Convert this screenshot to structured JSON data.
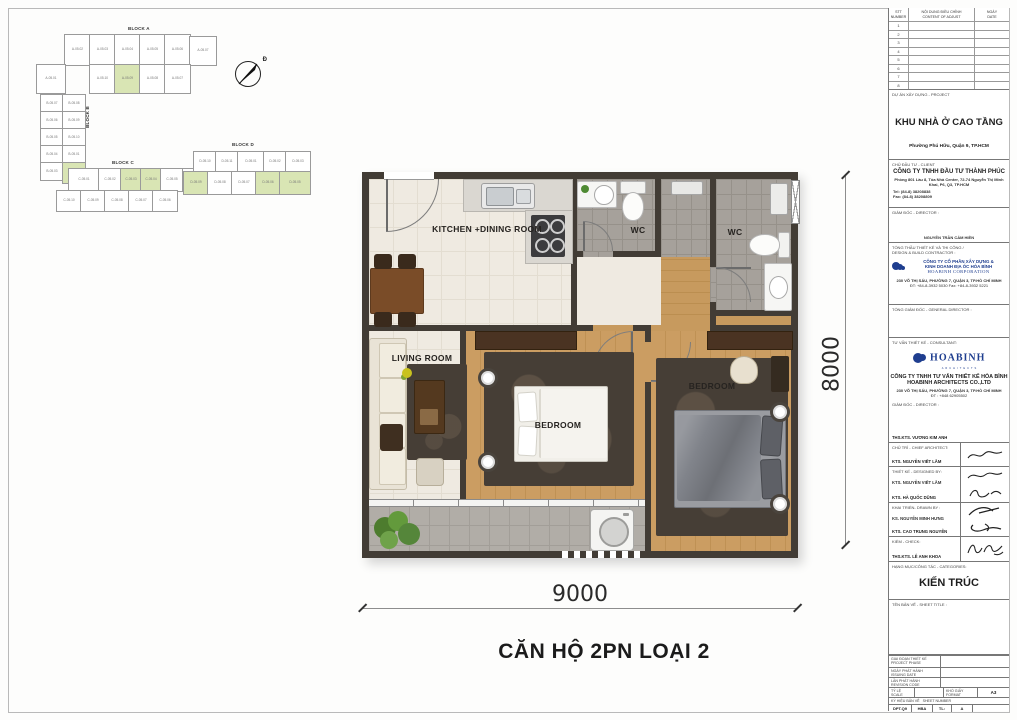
{
  "keyplan": {
    "block_a_label": "BLOCK A",
    "block_b_label": "BLOCK B",
    "block_c_label": "BLOCK C",
    "block_d_label": "BLOCK D",
    "compass_label": "Đ",
    "highlight_color": "#d9e5b4",
    "cells": [
      {
        "x": 36,
        "y": 16,
        "w": 25,
        "h": 30,
        "label": "A-05.02",
        "hl": false
      },
      {
        "x": 61,
        "y": 16,
        "w": 25,
        "h": 30,
        "label": "A-05.03",
        "hl": false
      },
      {
        "x": 86,
        "y": 16,
        "w": 25,
        "h": 30,
        "label": "A-05.04",
        "hl": false
      },
      {
        "x": 111,
        "y": 16,
        "w": 25,
        "h": 30,
        "label": "A-05.05",
        "hl": false
      },
      {
        "x": 136,
        "y": 16,
        "w": 25,
        "h": 30,
        "label": "A-05.06",
        "hl": false
      },
      {
        "x": 161,
        "y": 18,
        "w": 26,
        "h": 28,
        "label": "A-05.07",
        "hl": false
      },
      {
        "x": 8,
        "y": 46,
        "w": 28,
        "h": 28,
        "label": "A-05.01",
        "hl": false
      },
      {
        "x": 61,
        "y": 46,
        "w": 25,
        "h": 28,
        "label": "A-05.10",
        "hl": false
      },
      {
        "x": 86,
        "y": 46,
        "w": 25,
        "h": 28,
        "label": "A-05.09",
        "hl": true
      },
      {
        "x": 111,
        "y": 46,
        "w": 25,
        "h": 28,
        "label": "A-05.08",
        "hl": false
      },
      {
        "x": 136,
        "y": 46,
        "w": 25,
        "h": 28,
        "label": "A-05.07",
        "hl": false
      },
      {
        "x": 12,
        "y": 76,
        "w": 22,
        "h": 17,
        "label": "B-05.07",
        "hl": false
      },
      {
        "x": 34,
        "y": 76,
        "w": 22,
        "h": 17,
        "label": "B-05.08",
        "hl": false
      },
      {
        "x": 12,
        "y": 93,
        "w": 22,
        "h": 17,
        "label": "B-05.06",
        "hl": false
      },
      {
        "x": 34,
        "y": 93,
        "w": 22,
        "h": 17,
        "label": "B-05.09",
        "hl": false
      },
      {
        "x": 12,
        "y": 110,
        "w": 22,
        "h": 17,
        "label": "B-05.05",
        "hl": false
      },
      {
        "x": 34,
        "y": 110,
        "w": 22,
        "h": 17,
        "label": "B-05.10",
        "hl": false
      },
      {
        "x": 12,
        "y": 127,
        "w": 22,
        "h": 17,
        "label": "B-05.04",
        "hl": false
      },
      {
        "x": 34,
        "y": 127,
        "w": 22,
        "h": 17,
        "label": "B-05.01",
        "hl": false
      },
      {
        "x": 12,
        "y": 144,
        "w": 22,
        "h": 17,
        "label": "B-05.03",
        "hl": false
      },
      {
        "x": 34,
        "y": 144,
        "w": 22,
        "h": 20,
        "label": "B-05.02",
        "hl": true
      },
      {
        "x": 8,
        "y": 150,
        "w": 0,
        "h": 0,
        "label": "",
        "hl": false
      },
      {
        "x": 40,
        "y": 150,
        "w": 30,
        "h": 22,
        "label": "C-05.01",
        "hl": false
      },
      {
        "x": 70,
        "y": 150,
        "w": 22,
        "h": 22,
        "label": "C-05.02",
        "hl": false
      },
      {
        "x": 92,
        "y": 150,
        "w": 20,
        "h": 22,
        "label": "C-05.03",
        "hl": true
      },
      {
        "x": 112,
        "y": 150,
        "w": 20,
        "h": 22,
        "label": "C-05.04",
        "hl": true
      },
      {
        "x": 132,
        "y": 150,
        "w": 22,
        "h": 22,
        "label": "C-05.05",
        "hl": false
      },
      {
        "x": 154,
        "y": 150,
        "w": 18,
        "h": 22,
        "label": "C-05.06",
        "hl": false
      },
      {
        "x": 28,
        "y": 172,
        "w": 24,
        "h": 20,
        "label": "C-05.10",
        "hl": false
      },
      {
        "x": 52,
        "y": 172,
        "w": 24,
        "h": 20,
        "label": "C-05.09",
        "hl": false
      },
      {
        "x": 76,
        "y": 172,
        "w": 24,
        "h": 20,
        "label": "C-05.08",
        "hl": false
      },
      {
        "x": 100,
        "y": 172,
        "w": 24,
        "h": 20,
        "label": "C-05.07",
        "hl": false
      },
      {
        "x": 124,
        "y": 172,
        "w": 24,
        "h": 20,
        "label": "C-05.06",
        "hl": false
      },
      {
        "x": 165,
        "y": 133,
        "w": 22,
        "h": 20,
        "label": "D-05.10",
        "hl": false
      },
      {
        "x": 187,
        "y": 133,
        "w": 22,
        "h": 20,
        "label": "D-05.11",
        "hl": false
      },
      {
        "x": 209,
        "y": 133,
        "w": 26,
        "h": 20,
        "label": "D-05.01",
        "hl": false
      },
      {
        "x": 235,
        "y": 133,
        "w": 22,
        "h": 20,
        "label": "D-05.02",
        "hl": false
      },
      {
        "x": 257,
        "y": 133,
        "w": 24,
        "h": 20,
        "label": "D-05.03",
        "hl": false
      },
      {
        "x": 155,
        "y": 153,
        "w": 24,
        "h": 22,
        "label": "D-05.09",
        "hl": true
      },
      {
        "x": 179,
        "y": 153,
        "w": 24,
        "h": 22,
        "label": "D-05.08",
        "hl": false
      },
      {
        "x": 203,
        "y": 153,
        "w": 24,
        "h": 22,
        "label": "D-05.07",
        "hl": false
      },
      {
        "x": 227,
        "y": 153,
        "w": 24,
        "h": 22,
        "label": "D-05.06",
        "hl": true
      },
      {
        "x": 251,
        "y": 153,
        "w": 30,
        "h": 22,
        "label": "D-05.05",
        "hl": true
      }
    ]
  },
  "plan": {
    "rooms": {
      "kitchen": "KITCHEN +DINING ROOM",
      "living": "LIVING ROOM",
      "wc1": "WC",
      "wc2": "WC",
      "bedroom1": "BEDROOM",
      "bedroom2": "BEDROOM"
    },
    "dim_width": "9000",
    "dim_height": "8000",
    "title": "CĂN HỘ 2PN LOẠI 2"
  },
  "titleblock": {
    "revision": {
      "col1_vn": "STT",
      "col1_en": "NUMBER",
      "col2_vn": "NỘI DUNG ĐIỀU CHỈNH",
      "col2_en": "CONTENT OF ADJUST",
      "col3_vn": "NGÀY",
      "col3_en": "DATE",
      "rows": [
        "1",
        "2",
        "3",
        "4",
        "5",
        "6",
        "7",
        "8",
        "9"
      ]
    },
    "project": {
      "label": "DỰ ÁN XÂY DỰNG - PROJECT",
      "name": "KHU NHÀ Ở CAO TẦNG",
      "location": "Phường Phú Hữu, Quận 9, TP.HCM"
    },
    "client": {
      "label": "CHỦ ĐẦU TƯ - CLIENT",
      "name": "CÔNG TY TNHH ĐẦU TƯ THÀNH PHÚC",
      "address": "Phòng 801 Lầu 8, Tòa Nhà Center, 72-74 Nguyễn Thị Minh Khai, P6, Q3, TP.HCM",
      "tel": "Tel: (84-8) 38208838",
      "fax": "Fax: (84-8) 38208809"
    },
    "director": {
      "label": "GIÁM ĐỐC - DIRECTOR :",
      "name": "NGUYỄN TRẦN CẨM HIỀN"
    },
    "contractor": {
      "label_vn": "TỔNG THẦU THIẾT KẾ VÀ THI CÔNG /",
      "label_en": "DESIGN & BUILD CONTRACTOR :",
      "name_line1": "CÔNG TY CỔ PHẦN XÂY DỰNG &",
      "name_line2": "KINH DOANH ĐỊA ỐC HÒA BÌNH",
      "name_en": "HOABINH CORPORATION",
      "address": "230 VÕ THỊ SÁU, PHƯỜNG 7, QUẬN 3, TP.HỒ CHÍ MINH",
      "phone": "ĐT: +84-8-3932 5030   Fax: +84-8-3932 5221"
    },
    "general_director": {
      "label": "TỔNG GIÁM ĐỐC - GENERAL DIRECTOR :"
    },
    "consultant": {
      "label": "TƯ VẤN THIẾT KẾ - CONSULTANT:",
      "logo_text": "HOABINH",
      "logo_sub": "ARCHITECTS",
      "name_line1": "CÔNG TY TNHH TƯ VẤN THIẾT KẾ HÒA BÌNH",
      "name_line2": "HOABINH ARCHITECTS CO.,LTD",
      "address": "230 VÕ THỊ SÁU, PHƯỜNG 7, QUẬN 3, TP.HỒ CHÍ MINH",
      "phone": "ĐT : +848 62905502",
      "director_label": "GIÁM ĐỐC - DIRECTOR :",
      "director_name": "THS.KTS. VƯƠNG KIM ANH"
    },
    "chief_architect": {
      "label": "CHỦ TRÌ - CHIEF ARCHITECT:",
      "name": "KTS. NGUYỄN VIẾT LÃM"
    },
    "designed_by": {
      "label": "THIẾT KẾ - DESIGNED BY:",
      "names": [
        "KTS. NGUYỄN VIẾT LÃM",
        "KTS. HÀ QUỐC DŨNG"
      ]
    },
    "drawn_by": {
      "label": "KHAI TRIỂN- DRAWN BY :",
      "names": [
        "KS. NGUYỄN MINH HƯNG",
        "KTS. CAO TRUNG NGUYÊN"
      ]
    },
    "check": {
      "label": "KIỂM - CHECK:",
      "name": "THS.KTS. LÊ ANH KHOA"
    },
    "categories": {
      "label": "HẠNG MỤC/CÔNG TÁC - CATEGORIES:",
      "value": "KIẾN TRÚC"
    },
    "sheet_title": {
      "label": "TÊN BẢN VẼ - SHEET TITLE :"
    },
    "admin": {
      "phase_vn": "GIAI ĐOẠN THIẾT KẾ",
      "phase_en": "PROJECT PHASE",
      "issue_vn": "NGÀY PHÁT HÀNH",
      "issue_en": "ISSUING DATE",
      "rev_vn": "LẦN PHÁT HÀNH",
      "rev_en": "REVISION CODE",
      "scale_vn": "TỶ LỆ",
      "scale_en": "SCALE",
      "format_vn": "KHỔ GIẤY",
      "format_en": "FORMAT",
      "format_value": "A3",
      "sheetnum_vn": "KÝ HIỆU BẢN VẼ",
      "sheetnum_en": "SHEET NUMBER",
      "bottom_cells": [
        "DPT.Q9",
        "HBA",
        "TL:",
        "A",
        ""
      ]
    },
    "logo_color": "#1f3e8f"
  }
}
